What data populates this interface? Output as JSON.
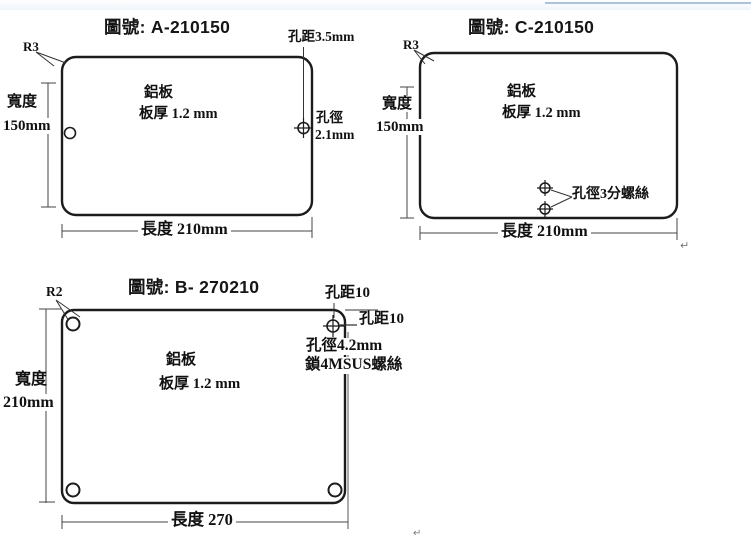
{
  "page": {
    "background": "#ffffff",
    "top_line_color": "#a9c3da",
    "line_color": "#1c1c1c",
    "dim_line_color": "#444444"
  },
  "diagrams": {
    "a": {
      "title": "圖號: A-210150",
      "radius_label": "R3",
      "hole_pitch_label": "孔距3.5mm",
      "width_label": "寬度",
      "width_value": "150mm",
      "material_label": "鋁板",
      "thickness_label": "板厚 1.2 mm",
      "hole_dia_label": "孔徑",
      "hole_dia_value": "2.1mm",
      "length_label": "長度 210mm"
    },
    "c": {
      "title": "圖號: C-210150",
      "radius_label": "R3",
      "width_label": "寬度",
      "width_value": "150mm",
      "material_label": "鋁板",
      "thickness_label": "板厚 1.2 mm",
      "hole_label": "孔徑3分螺絲",
      "length_label": "長度 210mm",
      "paragraph_mark": "↵"
    },
    "b": {
      "title": "圖號: B- 270210",
      "radius_label": "R2",
      "hole_pitch_top": "孔距10",
      "hole_pitch_right": "孔距10",
      "hole_dia_label": "孔徑4.2mm",
      "screw_label": "鎖4MSUS螺絲",
      "width_label": "寬度",
      "width_value": "210mm",
      "material_label": "鋁板",
      "thickness_label": "板厚 1.2 mm",
      "length_label": "長度 270",
      "paragraph_mark": "↵"
    }
  }
}
